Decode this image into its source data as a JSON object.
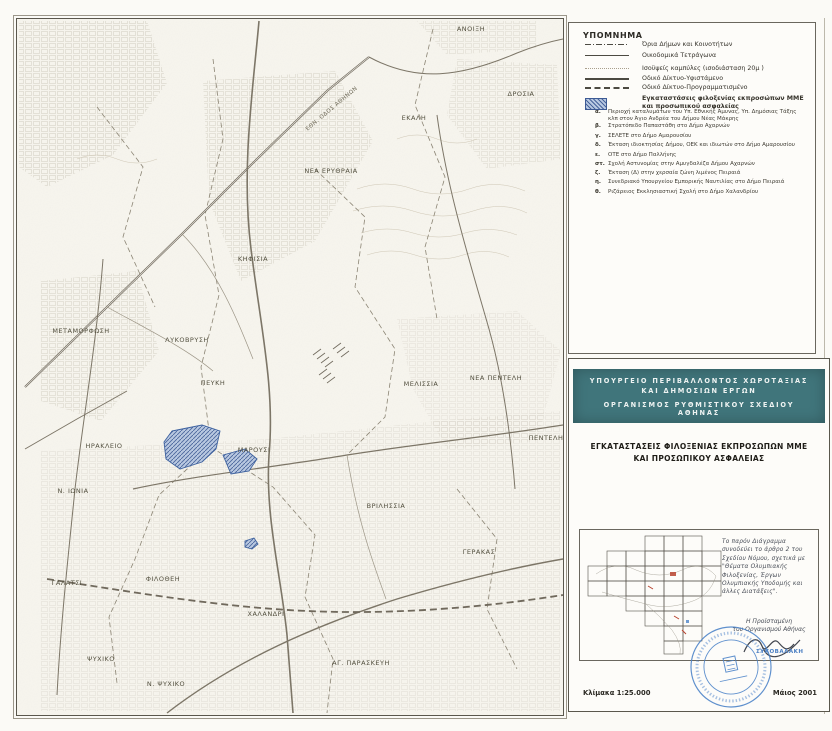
{
  "legend": {
    "title": "ΥΠΟΜΝΗΜΑ",
    "items": [
      {
        "symbol": "municipal-boundary-line",
        "label": "Όρια Δήμων και Κοινοτήτων"
      },
      {
        "symbol": "city-blocks-line",
        "label": "Οικοδομικά Τετράγωνα"
      },
      {
        "symbol": "contour-line",
        "label": "Ισοϋψείς καμπύλες (ισοδιάσταση 20μ )"
      },
      {
        "symbol": "road-existing-line",
        "label": "Οδικό Δίκτυο-Υφιστάμενο"
      },
      {
        "symbol": "road-planned-line",
        "label": "Οδικό Δίκτυο-Προγραμματισμένο"
      },
      {
        "symbol": "facility-hatch-swatch",
        "label": "Εγκαταστάσεις φιλοξενίας εκπροσώπων ΜΜΕ και προσωπικού ασφαλείας"
      }
    ],
    "sub_items": [
      {
        "letter": "α.",
        "label": "Περιοχή καταλυμάτων του Υπ. Εθνικής Άμυνας, Υπ. Δημόσιας Τάξης κλπ στον Άγιο Ανδρέα του Δήμου Νέας Μάκρης"
      },
      {
        "letter": "β.",
        "label": "Στρατόπεδο Παπαστάθη στο Δήμο Αχαρνών"
      },
      {
        "letter": "γ.",
        "label": "ΣΕΛΕΤΕ στο Δήμο Αμαρουσίου"
      },
      {
        "letter": "δ.",
        "label": "Έκταση ιδιοκτησίας Δήμου, ΟΕΚ και ιδιωτών στο Δήμο Αμαρουσίου"
      },
      {
        "letter": "ε.",
        "label": "ΟΤΕ στο Δήμο Παλλήνης"
      },
      {
        "letter": "στ.",
        "label": "Σχολή Αστυνομίας στην Αμυγδαλέζα Δήμου Αχαρνών"
      },
      {
        "letter": "ζ.",
        "label": "Έκταση (Δ) στην χερσαία ζώνη λιμένος Πειραιά"
      },
      {
        "letter": "η.",
        "label": "Συνεδριακό Υπουργείου Εμπορικής Ναυτιλίας στο Δήμο Πειραιά"
      },
      {
        "letter": "θ.",
        "label": "Ριζάρειος Εκκλησιαστική Σχολή στο Δήμο Χαλανδρίου"
      }
    ]
  },
  "map": {
    "labels": [
      {
        "text": "ΑΝΟΙΞΗ"
      },
      {
        "text": "ΔΡΟΣΙΑ"
      },
      {
        "text": "ΕΚΑΛΗ"
      },
      {
        "text": "ΝΕΑ ΕΡΥΘΡΑΙΑ"
      },
      {
        "text": "ΚΗΦΙΣΙΑ"
      },
      {
        "text": "ΜΕΤΑΜΟΡΦΩΣΗ"
      },
      {
        "text": "ΛΥΚΟΒΡΥΣΗ"
      },
      {
        "text": "ΠΕΥΚΗ"
      },
      {
        "text": "ΜΕΛΙΣΣΙΑ"
      },
      {
        "text": "ΝΕΑ ΠΕΝΤΕΛΗ"
      },
      {
        "text": "ΠΕΝΤΕΛΗ"
      },
      {
        "text": "ΗΡΑΚΛΕΙΟ"
      },
      {
        "text": "ΜΑΡΟΥΣΙ"
      },
      {
        "text": "Ν. ΙΩΝΙΑ"
      },
      {
        "text": "ΒΡΙΛΗΣΣΙΑ"
      },
      {
        "text": "ΓΕΡΑΚΑΣ"
      },
      {
        "text": "ΓΑΛΑΤΣΙ"
      },
      {
        "text": "ΦΙΛΟΘΕΗ"
      },
      {
        "text": "ΧΑΛΑΝΔΡΙ"
      },
      {
        "text": "ΨΥΧΙΚΟ"
      },
      {
        "text": "ΑΓ. ΠΑΡΑΣΚΕΥΗ"
      },
      {
        "text": "Ν. ΨΥΧΙΚΟ"
      },
      {
        "text": "ΕΘΝ. ΟΔΟΣ ΑΘΗΝΩΝ"
      }
    ]
  },
  "title_block": {
    "ministry": "ΥΠΟΥΡΓΕΙΟ ΠΕΡΙΒΑΛΛΟΝΤΟΣ ΧΩΡΟΤΑΞΙΑΣ ΚΑΙ ΔΗΜΟΣΙΩΝ ΕΡΓΩΝ",
    "organization": "ΟΡΓΑΝΙΣΜΟΣ ΡΥΘΜΙΣΤΙΚΟΥ ΣΧΕΔΙΟΥ ΑΘΗΝΑΣ",
    "document_title": "ΕΓΚΑΤΑΣΤΑΣΕΙΣ ΦΙΛΟΞΕΝΙΑΣ ΕΚΠΡΟΣΩΠΩΝ ΜΜΕ ΚΑΙ ΠΡΟΣΩΠΙΚΟΥ ΑΣΦΑΛΕΙΑΣ",
    "handwritten_note": "Το παρόν Διάγραμμα συνοδεύει το άρθρο 2 του Σχεδίου Νόμου, σχετικά με \"Θέματα Ολυμπιακής Φιλοξενίας, Έργων Ολυμπιακής Υποδομής και άλλες Διατάξεις\".",
    "signature_caption_1": "Η Προϊσταμένη",
    "signature_caption_2": "του Οργανισμού Αθήνας",
    "signatory_name": "ΣΥΚΟΒΑΛΑΚΗ",
    "scale": "Κλίμακα 1:25.000",
    "date": "Μάιος 2001"
  },
  "colors": {
    "band_teal": "#40757b",
    "stamp_blue": "#4a82c8",
    "facility_blue": "#8fa8cf",
    "paper": "#fbfaf6"
  }
}
